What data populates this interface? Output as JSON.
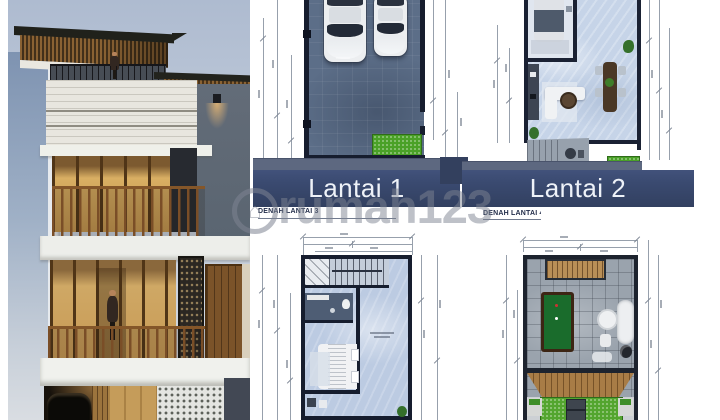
{
  "watermark": {
    "brand": "rumah123",
    "logo_icon": "house-in-circle"
  },
  "floor_plans": {
    "plan1": {
      "label": "Lantai 1"
    },
    "plan2": {
      "label": "Lantai 2"
    },
    "plan3": {
      "caption": "DENAH LANTAI 3"
    },
    "plan4": {
      "caption": "DENAH LANTAI 4"
    }
  },
  "visible_features": {
    "plan1_cars_in_carport": 2,
    "plan4_has_billiard_table": true,
    "house_render_person_on_balcony": true
  },
  "colors": {
    "label_band": "#394a6b",
    "band_text": "#eef2f8",
    "grass": "#4aa127",
    "carport_floor": "#5c6e88",
    "plan_floor_light": "#c6d4e8",
    "rooftop_tile": "#9aa3ad",
    "billiard_felt": "#1a6c2c",
    "deck_wood": "#a87c46",
    "sky": "#aebbd0",
    "watermark_gray": "#7d8491"
  }
}
